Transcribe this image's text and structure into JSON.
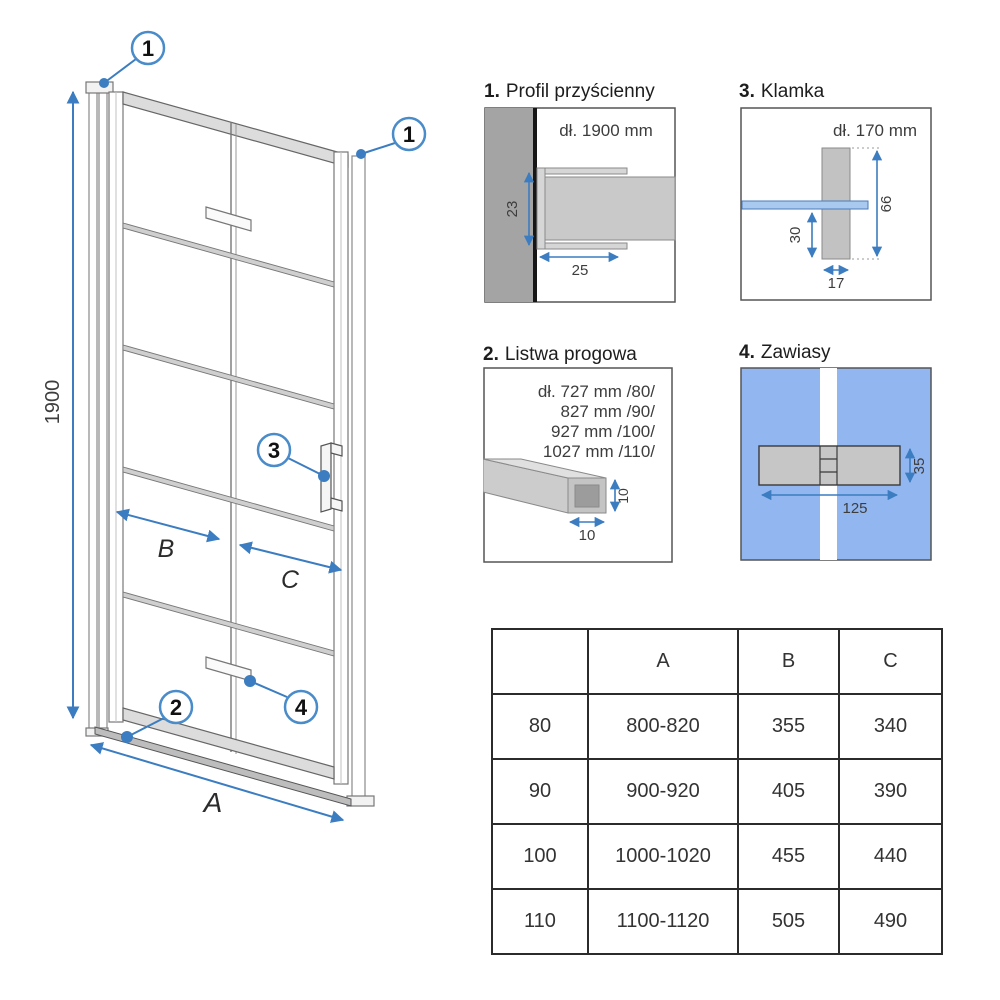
{
  "colors": {
    "accent_blue": "#3b7dc0",
    "handle_bar_blue": "#a9c9ef",
    "hinge_panel_bg_blue": "#92b6ef",
    "wall_gray": "#a4a4a4",
    "metal_gray": "#c9c9c9"
  },
  "main_diagram": {
    "height_dim": "1900",
    "width_dim": "A",
    "left_panel_dim": "B",
    "right_panel_dim": "C",
    "callout_1": "1",
    "callout_2": "2",
    "callout_3": "3",
    "callout_4": "4"
  },
  "panels": {
    "profil": {
      "num": "1.",
      "title": "Profil przyścienny",
      "length_label": "dł. 1900 mm",
      "depth_dim": "23",
      "width_dim": "25"
    },
    "listwa": {
      "num": "2.",
      "title": "Listwa progowa",
      "length_lines": [
        "dł. 727 mm /80/",
        "827 mm /90/",
        "927 mm /100/",
        "1027 mm /110/"
      ],
      "height_dim": "10",
      "width_dim": "10"
    },
    "klamka": {
      "num": "3.",
      "title": "Klamka",
      "length_label": "dł. 170 mm",
      "offset_dim": "30",
      "width_dim": "17",
      "height_dim": "66"
    },
    "zawiasy": {
      "num": "4.",
      "title": "Zawiasy",
      "width_dim": "125",
      "height_dim": "35"
    }
  },
  "table": {
    "headers": [
      "",
      "A",
      "B",
      "C"
    ],
    "rows": [
      [
        "80",
        "800-820",
        "355",
        "340"
      ],
      [
        "90",
        "900-920",
        "405",
        "390"
      ],
      [
        "100",
        "1000-1020",
        "455",
        "440"
      ],
      [
        "110",
        "1100-1120",
        "505",
        "490"
      ]
    ]
  }
}
